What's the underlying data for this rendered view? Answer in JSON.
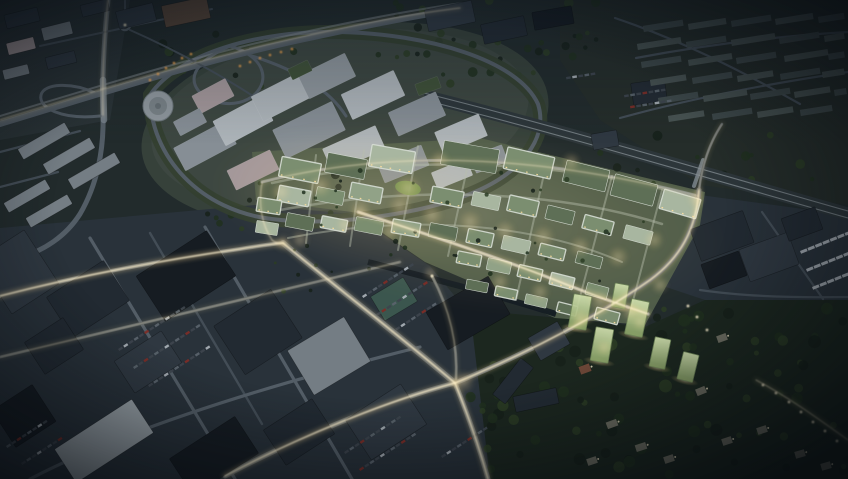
{
  "scene": {
    "alt": "Aerial dusk rendering of an urban masterplan: a brightly lit new district with green roofs at the center, an existing grey hospital campus and highway interchange to the upper left, a railway line and terraced-house suburb to the upper right, dark industrial blocks with parking lots at the lower left, and a wooded hillside with glowing green residential towers at the lower right. Streets carry warm light trails.",
    "palette": {
      "bg": "#222b2c",
      "ground-city": "#2d3639",
      "ground-campus": "#36413a",
      "ground-masterplan": "#4f5c49",
      "ground-industrial": "#29323a",
      "ground-suburb": "#252d2a",
      "ground-forest": "#1c271f",
      "road": "#535d66",
      "road-bright": "#7f8991",
      "road-dim": "#434d56",
      "rail-band": "#2d363a",
      "rail-line": "#7f898e",
      "bldg-dark-1": "#161c22",
      "bldg-dark-2": "#222a32",
      "bldg-dark-3": "#2f3841",
      "bldg-light-1": "#9aa3a9",
      "bldg-light-2": "#747d84",
      "campus-wall": "#8f979d",
      "campus-roof-a": "#adb4b9",
      "campus-roof-b": "#868e95",
      "campus-pink": "#a3979a",
      "mp-facade": "#d6ddd4",
      "mp-roof-a": "#7b8e70",
      "mp-roof-b": "#5e6f56",
      "mp-roof-c": "#a8b6a0",
      "mp-roof-d": "#91a287",
      "mp-court": "#3f5138",
      "lawn": "#829b58",
      "teal-wall": "#3b564e",
      "brown-roof": "#584639",
      "suburb-roof": "#3f4a4b",
      "suburb-roof-2": "#485352",
      "house-wall": "#6e6e62",
      "house-red": "#6b4637",
      "tower-dk": "#6d8457",
      "water": "#121a22",
      "glow": "#ffdf9e",
      "glow-core": "#fff3d2",
      "glow-amber": "#f2a44c",
      "tree-1": "#16211a",
      "tree-2": "#20301e",
      "tree-3": "#2b3d24",
      "car-a": "#3d454d",
      "car-b": "#5a636b",
      "car-c": "#a6aeb4",
      "car-d": "#7c2d27"
    },
    "campus_buildings": [
      [
        205,
        146,
        58,
        26,
        -28,
        "campus-roof-b"
      ],
      [
        243,
        121,
        54,
        28,
        -28,
        "campus-roof-a"
      ],
      [
        283,
        96,
        58,
        28,
        -27,
        "campus-roof-a"
      ],
      [
        327,
        76,
        52,
        26,
        -26,
        "campus-wall"
      ],
      [
        373,
        95,
        58,
        28,
        -25,
        "campus-roof-a"
      ],
      [
        417,
        114,
        52,
        26,
        -24,
        "campus-roof-b"
      ],
      [
        461,
        134,
        48,
        24,
        -23,
        "campus-roof-a"
      ],
      [
        309,
        130,
        66,
        32,
        -26,
        "campus-roof-b"
      ],
      [
        354,
        149,
        58,
        26,
        -24,
        "campus-roof-a"
      ],
      [
        403,
        164,
        48,
        22,
        -22,
        "campus-roof-b"
      ],
      [
        253,
        170,
        48,
        22,
        -26,
        "campus-pink"
      ],
      [
        213,
        96,
        38,
        20,
        -28,
        "campus-pink"
      ],
      [
        452,
        174,
        38,
        18,
        -22,
        "campus-roof-a"
      ],
      [
        489,
        159,
        34,
        18,
        -21,
        "campus-roof-b"
      ],
      [
        190,
        122,
        30,
        16,
        -28,
        "campus-roof-b"
      ],
      [
        300,
        70,
        22,
        12,
        -26,
        "mp-court"
      ],
      [
        428,
        86,
        24,
        12,
        -20,
        "mp-court"
      ]
    ],
    "industrial_buildings": [
      [
        88,
        299,
        68,
        48,
        -33,
        "bldg-dark-2"
      ],
      [
        186,
        276,
        84,
        54,
        -33,
        "bldg-dark-1"
      ],
      [
        258,
        332,
        68,
        58,
        -33,
        "bldg-dark-2"
      ],
      [
        148,
        362,
        56,
        38,
        -33,
        "bldg-dark-3"
      ],
      [
        104,
        441,
        92,
        40,
        -33,
        "bldg-light-1"
      ],
      [
        214,
        456,
        78,
        44,
        -33,
        "bldg-dark-1"
      ],
      [
        329,
        356,
        66,
        52,
        -31,
        "bldg-light-2"
      ],
      [
        299,
        432,
        58,
        42,
        -33,
        "bldg-dark-2"
      ],
      [
        386,
        422,
        66,
        48,
        -33,
        "bldg-dark-3"
      ],
      [
        18,
        272,
        56,
        64,
        -33,
        "bldg-dark-3"
      ],
      [
        54,
        346,
        46,
        38,
        -33,
        "bldg-dark-2"
      ],
      [
        24,
        416,
        48,
        44,
        -33,
        "bldg-dark-1"
      ],
      [
        468,
        313,
        72,
        44,
        -30,
        "bldg-dark-1"
      ],
      [
        394,
        299,
        38,
        28,
        -31,
        "teal-wall"
      ],
      [
        513,
        381,
        46,
        16,
        -52,
        "bldg-dark-2"
      ],
      [
        536,
        400,
        44,
        16,
        -12,
        "bldg-dark-2"
      ],
      [
        549,
        341,
        34,
        26,
        -30,
        "bldg-dark-3"
      ],
      [
        722,
        236,
        56,
        34,
        -20,
        "bldg-dark-2"
      ],
      [
        769,
        257,
        52,
        34,
        -20,
        "bldg-dark-3"
      ],
      [
        724,
        270,
        40,
        26,
        -20,
        "bldg-dark-1"
      ],
      [
        802,
        224,
        36,
        24,
        -20,
        "bldg-dark-2"
      ],
      [
        450,
        16,
        48,
        22,
        -12,
        "bldg-dark-3"
      ],
      [
        504,
        30,
        44,
        20,
        -12,
        "bldg-dark-2"
      ],
      [
        553,
        18,
        40,
        18,
        -10,
        "bldg-dark-1"
      ],
      [
        186,
        12,
        46,
        22,
        -12,
        "brown-roof"
      ],
      [
        136,
        16,
        38,
        18,
        -14,
        "bldg-dark-3"
      ],
      [
        22,
        18,
        34,
        14,
        -14,
        "bldg-dark-3"
      ],
      [
        57,
        31,
        30,
        13,
        -14,
        "bldg-light-2"
      ],
      [
        21,
        46,
        28,
        12,
        -14,
        "campus-pink"
      ],
      [
        61,
        60,
        30,
        12,
        -14,
        "bldg-dark-3"
      ],
      [
        16,
        72,
        26,
        10,
        -14,
        "bldg-light-2"
      ],
      [
        95,
        8,
        28,
        12,
        -14,
        "bldg-dark-3"
      ],
      [
        44,
        141,
        54,
        12,
        -30,
        "bldg-light-2"
      ],
      [
        69,
        156,
        54,
        12,
        -30,
        "bldg-light-2"
      ],
      [
        94,
        171,
        54,
        12,
        -30,
        "bldg-light-2"
      ],
      [
        27,
        196,
        48,
        11,
        -30,
        "bldg-light-2"
      ],
      [
        49,
        211,
        48,
        11,
        -30,
        "bldg-light-2"
      ],
      [
        649,
        92,
        34,
        22,
        -8,
        "bldg-dark-2"
      ],
      [
        605,
        140,
        26,
        16,
        -10,
        "bldg-dark-3"
      ]
    ],
    "masterplan_blocks": [
      [
        300,
        170,
        40,
        20,
        11,
        "mp-roof-a",
        1
      ],
      [
        346,
        166,
        40,
        20,
        11,
        "mp-roof-b",
        0
      ],
      [
        392,
        159,
        44,
        22,
        10,
        "mp-roof-c",
        1
      ],
      [
        470,
        157,
        56,
        24,
        10,
        "mp-roof-b",
        0
      ],
      [
        529,
        163,
        48,
        22,
        13,
        "mp-roof-a",
        1
      ],
      [
        586,
        176,
        44,
        22,
        14,
        "mp-roof-b",
        0
      ],
      [
        634,
        190,
        44,
        22,
        15,
        "mp-roof-b",
        0
      ],
      [
        680,
        204,
        38,
        20,
        16,
        "mp-roof-c",
        1
      ],
      [
        294,
        196,
        32,
        16,
        11,
        "mp-roof-c",
        1
      ],
      [
        330,
        196,
        28,
        14,
        11,
        "mp-roof-a",
        0
      ],
      [
        366,
        193,
        32,
        16,
        11,
        "mp-roof-d",
        1
      ],
      [
        447,
        197,
        32,
        16,
        11,
        "mp-roof-a",
        1
      ],
      [
        486,
        201,
        28,
        14,
        12,
        "mp-roof-c",
        0
      ],
      [
        523,
        206,
        30,
        16,
        13,
        "mp-roof-a",
        1
      ],
      [
        560,
        215,
        28,
        14,
        14,
        "mp-roof-b",
        0
      ],
      [
        598,
        225,
        30,
        14,
        15,
        "mp-roof-a",
        1
      ],
      [
        638,
        235,
        28,
        14,
        15,
        "mp-roof-c",
        0
      ],
      [
        300,
        222,
        28,
        14,
        11,
        "mp-roof-b",
        0
      ],
      [
        334,
        224,
        26,
        12,
        11,
        "mp-roof-c",
        1
      ],
      [
        369,
        226,
        28,
        14,
        11,
        "mp-roof-a",
        0
      ],
      [
        406,
        228,
        28,
        14,
        10,
        "mp-roof-d",
        1
      ],
      [
        443,
        232,
        28,
        14,
        11,
        "mp-roof-b",
        0
      ],
      [
        480,
        238,
        26,
        14,
        12,
        "mp-roof-a",
        1
      ],
      [
        516,
        245,
        28,
        14,
        13,
        "mp-roof-c",
        0
      ],
      [
        552,
        252,
        26,
        12,
        14,
        "mp-roof-a",
        1
      ],
      [
        589,
        260,
        26,
        12,
        15,
        "mp-roof-b",
        0
      ],
      [
        469,
        259,
        24,
        12,
        11,
        "mp-roof-a",
        1
      ],
      [
        499,
        266,
        24,
        12,
        12,
        "mp-roof-d",
        0
      ],
      [
        530,
        273,
        24,
        12,
        13,
        "mp-roof-a",
        1
      ],
      [
        562,
        281,
        24,
        12,
        14,
        "mp-roof-c",
        1
      ],
      [
        597,
        291,
        22,
        12,
        15,
        "mp-roof-a",
        0
      ],
      [
        477,
        286,
        22,
        10,
        11,
        "mp-roof-b",
        0
      ],
      [
        506,
        293,
        22,
        10,
        12,
        "mp-roof-a",
        1
      ],
      [
        536,
        301,
        22,
        10,
        13,
        "mp-roof-d",
        0
      ],
      [
        567,
        309,
        20,
        10,
        14,
        "mp-roof-b",
        1
      ],
      [
        607,
        316,
        24,
        12,
        15,
        "mp-roof-a",
        1
      ],
      [
        269,
        206,
        24,
        14,
        9,
        "mp-roof-a",
        1
      ],
      [
        267,
        228,
        22,
        12,
        9,
        "mp-roof-c",
        0
      ]
    ],
    "suburb_rows": [
      [
        643,
        26,
        40
      ],
      [
        688,
        24,
        38
      ],
      [
        731,
        21,
        40
      ],
      [
        775,
        19,
        38
      ],
      [
        818,
        17,
        26
      ],
      [
        637,
        44,
        44
      ],
      [
        686,
        42,
        40
      ],
      [
        731,
        40,
        44
      ],
      [
        779,
        38,
        40
      ],
      [
        824,
        36,
        20
      ],
      [
        641,
        62,
        40
      ],
      [
        688,
        60,
        44
      ],
      [
        736,
        58,
        40
      ],
      [
        784,
        56,
        44
      ],
      [
        828,
        54,
        16
      ],
      [
        650,
        80,
        36
      ],
      [
        692,
        78,
        40
      ],
      [
        737,
        76,
        36
      ],
      [
        780,
        74,
        40
      ],
      [
        822,
        72,
        22
      ],
      [
        658,
        98,
        40
      ],
      [
        703,
        96,
        44
      ],
      [
        750,
        94,
        40
      ],
      [
        794,
        92,
        36
      ],
      [
        834,
        90,
        12
      ],
      [
        668,
        116,
        36
      ],
      [
        712,
        114,
        40
      ],
      [
        757,
        112,
        36
      ],
      [
        800,
        110,
        32
      ]
    ],
    "green_towers": [
      [
        580,
        312,
        18,
        34,
        10
      ],
      [
        602,
        345,
        18,
        34,
        10
      ],
      [
        637,
        318,
        18,
        36,
        12
      ],
      [
        660,
        353,
        16,
        30,
        12
      ],
      [
        688,
        367,
        16,
        28,
        14
      ],
      [
        620,
        296,
        14,
        24,
        10
      ]
    ],
    "forest_houses": [
      [
        585,
        369,
        11,
        8,
        -20,
        "house-red"
      ],
      [
        612,
        424,
        11,
        7,
        -20,
        "house-wall"
      ],
      [
        641,
        447,
        11,
        7,
        -18,
        "house-wall"
      ],
      [
        669,
        459,
        10,
        7,
        -18,
        "house-wall"
      ],
      [
        701,
        391,
        10,
        7,
        -22,
        "house-wall"
      ],
      [
        727,
        441,
        10,
        7,
        -18,
        "house-wall"
      ],
      [
        762,
        430,
        10,
        7,
        -18,
        "house-wall"
      ],
      [
        800,
        454,
        10,
        7,
        -16,
        "house-wall"
      ],
      [
        592,
        461,
        10,
        7,
        -18,
        "house-wall"
      ],
      [
        722,
        338,
        10,
        7,
        -20,
        "house-wall"
      ],
      [
        826,
        466,
        10,
        7,
        -16,
        "house-wall"
      ]
    ],
    "car_rows": [
      [
        118,
        349,
        -33,
        13,
        0
      ],
      [
        133,
        367,
        -33,
        13,
        0
      ],
      [
        148,
        385,
        -33,
        12,
        0
      ],
      [
        362,
        296,
        -33,
        10,
        0
      ],
      [
        376,
        314,
        -33,
        10,
        0
      ],
      [
        390,
        332,
        -33,
        9,
        0
      ],
      [
        344,
        452,
        -33,
        11,
        0
      ],
      [
        359,
        469,
        -33,
        11,
        0
      ],
      [
        441,
        456,
        -33,
        9,
        0
      ],
      [
        6,
        446,
        -33,
        8,
        0
      ],
      [
        21,
        463,
        -33,
        8,
        0
      ],
      [
        800,
        251,
        -22,
        7,
        1
      ],
      [
        806,
        269,
        -22,
        7,
        1
      ],
      [
        812,
        287,
        -22,
        7,
        1
      ],
      [
        624,
        95,
        -9,
        7,
        0
      ],
      [
        630,
        106,
        -9,
        7,
        0
      ],
      [
        566,
        77,
        -9,
        5,
        0
      ]
    ],
    "tree_patches": [
      [
        560,
        300,
        288,
        175,
        60,
        7,
        2.5,
        6.5
      ],
      [
        470,
        340,
        120,
        135,
        26,
        3,
        2.5,
        6
      ],
      [
        150,
        32,
        400,
        55,
        22,
        11,
        2,
        5
      ],
      [
        160,
        170,
        200,
        60,
        14,
        5,
        2,
        4.5
      ],
      [
        600,
        130,
        240,
        60,
        16,
        9,
        2,
        5
      ],
      [
        360,
        0,
        240,
        60,
        18,
        13,
        2,
        5
      ],
      [
        470,
        20,
        160,
        60,
        14,
        21,
        2,
        4.5
      ]
    ],
    "court_tree_patches": [
      [
        272,
        162,
        400,
        130,
        40,
        17,
        1.2,
        2.6
      ]
    ],
    "street_glows": [
      [
        320,
        186,
        12
      ],
      [
        360,
        210,
        11
      ],
      [
        400,
        206,
        12
      ],
      [
        432,
        215,
        11
      ],
      [
        470,
        222,
        12
      ],
      [
        505,
        231,
        11
      ],
      [
        543,
        237,
        12
      ],
      [
        580,
        247,
        11
      ],
      [
        618,
        257,
        11
      ],
      [
        654,
        240,
        10
      ],
      [
        300,
        240,
        10
      ],
      [
        281,
        192,
        10
      ],
      [
        408,
        188,
        14
      ],
      [
        430,
        273,
        7
      ],
      [
        500,
        282,
        10
      ],
      [
        540,
        292,
        10
      ],
      [
        600,
        302,
        12
      ],
      [
        630,
        312,
        10
      ],
      [
        463,
        382,
        12
      ],
      [
        283,
        243,
        9
      ],
      [
        696,
        199,
        9
      ],
      [
        660,
        285,
        9
      ],
      [
        580,
        318,
        9
      ],
      [
        604,
        348,
        8
      ],
      [
        640,
        322,
        8
      ],
      [
        571,
        162,
        10
      ],
      [
        440,
        160,
        10
      ],
      [
        390,
        232,
        9
      ],
      [
        345,
        225,
        9
      ]
    ],
    "lamps_warm": [
      [
        763,
        385
      ],
      [
        776,
        393
      ],
      [
        789,
        402
      ],
      [
        801,
        412
      ],
      [
        813,
        422
      ],
      [
        825,
        431
      ],
      [
        837,
        441
      ],
      [
        697,
        317
      ],
      [
        707,
        330
      ],
      [
        688,
        306
      ],
      [
        432,
        276
      ],
      [
        125,
        25
      ]
    ],
    "lamps_amber": [
      [
        150,
        80
      ],
      [
        158,
        74
      ],
      [
        166,
        68
      ],
      [
        174,
        63
      ],
      [
        182,
        58
      ],
      [
        191,
        54
      ],
      [
        240,
        66
      ],
      [
        250,
        62
      ],
      [
        260,
        58
      ],
      [
        270,
        55
      ],
      [
        281,
        52
      ],
      [
        292,
        49
      ]
    ]
  }
}
